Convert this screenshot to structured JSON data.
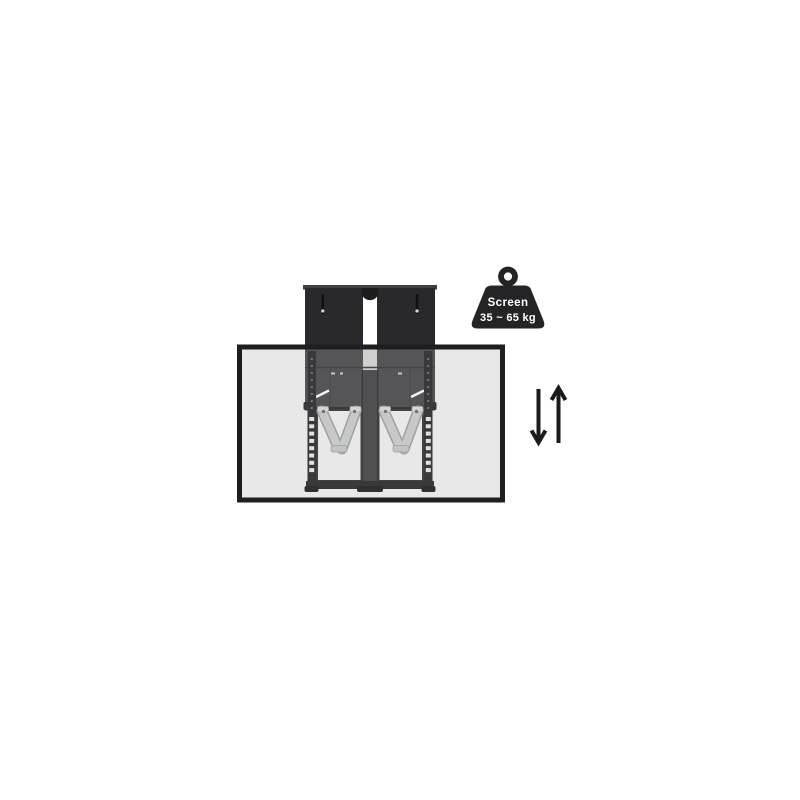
{
  "page": {
    "background": "#ffffff",
    "description": "Product illustration of a motorized height-adjustable TV wall mount shown behind a translucent screen panel, with a weight capacity badge and vertical motion arrows"
  },
  "badge": {
    "label": "Screen",
    "range": "35 ~ 65 kg"
  },
  "icons": {
    "weight_badge": "kettlebell-weight-icon",
    "motion_down": "arrow-down-icon",
    "motion_up": "arrow-up-icon"
  },
  "colors": {
    "screen_fill": "#e8e8e8",
    "screen_border": "#1e1e20",
    "bracket_dark": "#29292b",
    "housing_gray": "#555557",
    "frame_dark": "#39393c",
    "column_gray": "#505053",
    "arm_silver": "#c7c9c8",
    "badge_fill": "#242426",
    "badge_text": "#ffffff",
    "arrow": "#1b1b1b"
  }
}
